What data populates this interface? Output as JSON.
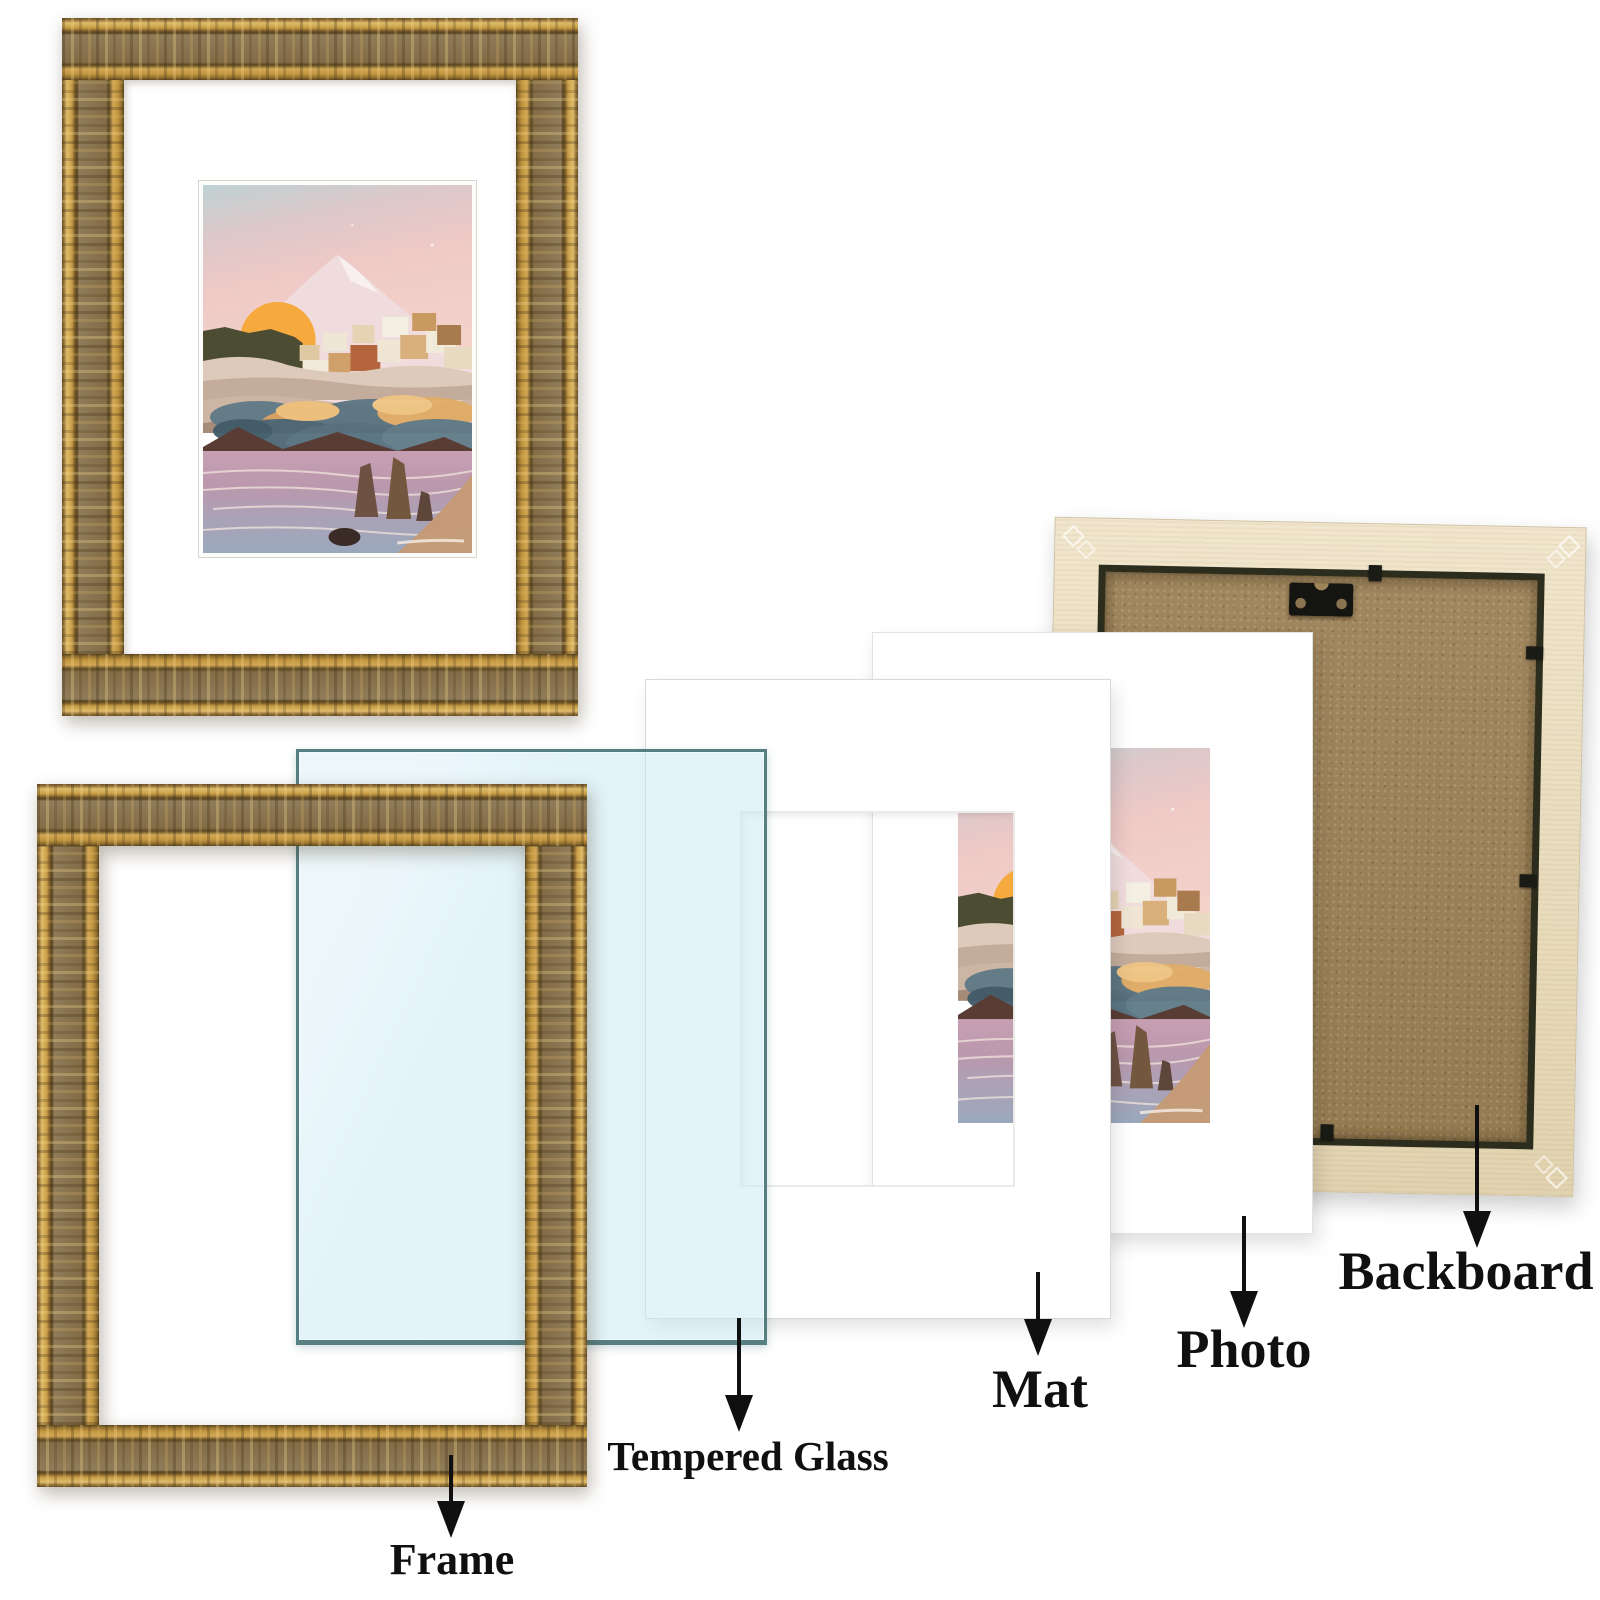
{
  "diagram": {
    "type": "product-parts-diagram",
    "product": "ornate picture frame exploded view",
    "labels": {
      "frame": "Frame",
      "tempered_glass": "Tempered Glass",
      "mat": "Mat",
      "photo": "Photo",
      "backboard": "Backboard"
    },
    "colors": {
      "frame_gold": "#c59b44",
      "frame_pattern_band": "#8a7450",
      "glass_fill": "#d9edf6",
      "glass_edge": "#4a7a7d",
      "mat_white": "#ffffff",
      "photo_sun_orange": "#f6a93d",
      "photo_sky_pink": "#f0cbc8",
      "backboard_trim_cream": "#ece0c3",
      "backboard_mdf_brown": "#9d8459",
      "hardware_black": "#141410",
      "label_text": "#101010",
      "background": "#ffffff"
    }
  }
}
